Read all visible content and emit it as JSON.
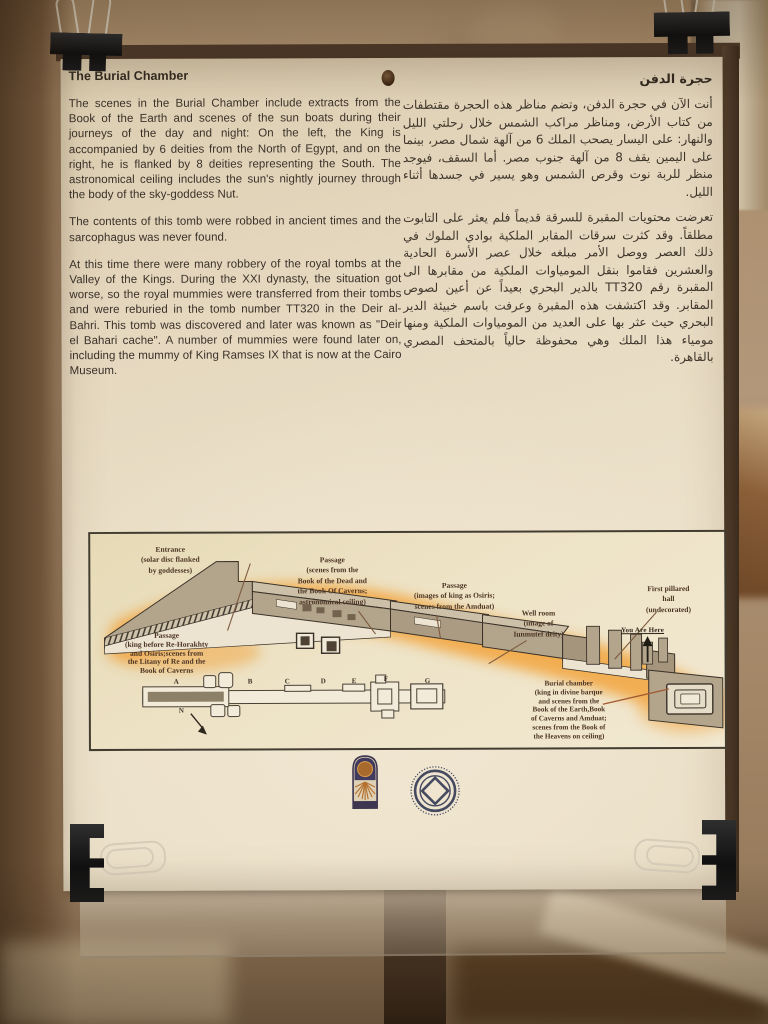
{
  "sign": {
    "english": {
      "title": "The Burial Chamber",
      "paragraphs": [
        "The scenes in the Burial Chamber include extracts from the Book of the Earth and scenes of the sun boats during their journeys of the day and night: On the left, the King is accompanied by 6 deities from the North of Egypt, and on the right, he is flanked by 8 deities representing the South. The astronomical ceiling includes the sun's nightly journey through the body of the sky-goddess Nut.",
        "The contents of this tomb were robbed in ancient times and the sarcophagus was never found.",
        "At this time there were many robbery of the royal tombs at the Valley of the Kings. During the XXI dynasty, the situation got worse, so the royal mummies were transferred from their tombs and were reburied in the tomb number TT320 in the Deir al-Bahri. This tomb was discovered and later was known as \"Deir el Bahari cache\". A number of mummies were found later on, including the mummy of King Ramses IX that is now at the Cairo Museum."
      ]
    },
    "arabic": {
      "title": "حجرة الدفن",
      "paragraphs": [
        "أنت الآن في حجرة الدفن، وتضم مناظر هذه الحجرة مقتطفات من كتاب الأرض، ومناظر مراكب الشمس خلال رحلتي الليل والنهار: على اليسار يصحب الملك 6 من آلهة شمال مصر، بينما على اليمين يقف 8 من آلهة جنوب مصر. أما السقف، فيوجد منظر للربة نوت وقرص الشمس وهو يسير في جسدها أثناء الليل.",
        "تعرضت محتويات المقبرة للسرقة قديماً فلم يعثر على التابوت مطلقاً. وقد كثرت سرقات المقابر الملكية بوادي الملوك في ذلك العصر ووصل الأمر مبلغه خلال عصر الأسرة الحادية والعشرين فقاموا بنقل المومياوات الملكية من مقابرها الى المقبرة رقم TT320 بالدير البحري بعيداً عن أعين لصوص المقابر. وقد اكتشفت هذه المقبرة وعرفت باسم خبيئة الدير البحري حيث عثر بها على العديد من المومياوات الملكية ومنها مومياء هذا الملك وهي محفوظة حالياً بالمتحف المصري بالقاهرة."
      ]
    },
    "diagram": {
      "labels": [
        "Entrance\n(solar disc flanked\nby goddesses)",
        "Passage\n(scenes from the\nBook of the Dead and\nthe Book Of Caverns;\nastronomical ceiling)",
        "Passage\n(images of king as Osiris;\nscenes from the Amduat)",
        "Well room\n(image of\nIunmutef deity)",
        "First pillared hall\n(undecorated)",
        "Passage\n(king before Re-Horakhty\nand Osiris;scenes from\nthe Litany of Re and the\nBook of Caverns",
        "Burial chamber\n(king in divine barque\nand scenes from the\nBook of the Earth,Book\nof Caverns and Amduat;\nscenes from the Book of\nthe Heavens on ceiling)"
      ],
      "you_are_here": "You Are Here",
      "plan_letters": [
        "A",
        "B",
        "C",
        "D",
        "E",
        "F",
        "G"
      ],
      "north_label": "N"
    },
    "logos": {
      "left_icon": "sun-arch-emblem",
      "right_icon": "supreme-council-of-antiquities-emblem"
    },
    "colors": {
      "paper": "#e9ddc2",
      "wall": "#a98d6b",
      "board_edge": "#4e3a29",
      "diagram_glow": "#f2a43c",
      "clip": "#141414",
      "body_text": "#3a3129",
      "diagram_label": "#4b3423"
    }
  }
}
